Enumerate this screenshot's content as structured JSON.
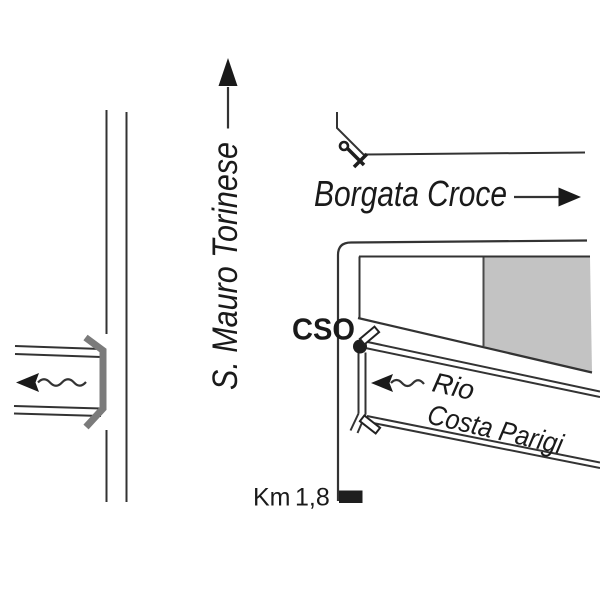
{
  "map": {
    "street_label": "S. Mauro Torinese",
    "district_label": "Borgata Croce",
    "venue_label": "CSO",
    "river_label_line1": "Rio",
    "river_label_line2": "Costa Parigi",
    "km_label": "Km",
    "km_value": "1,8"
  },
  "colors": {
    "background": "#ffffff",
    "ink": "#333333",
    "text": "#1a1a1a",
    "block_gray": "#c3c3c3",
    "barrier_gray": "#7b7b7b",
    "marker_black": "#1e1e1e"
  }
}
